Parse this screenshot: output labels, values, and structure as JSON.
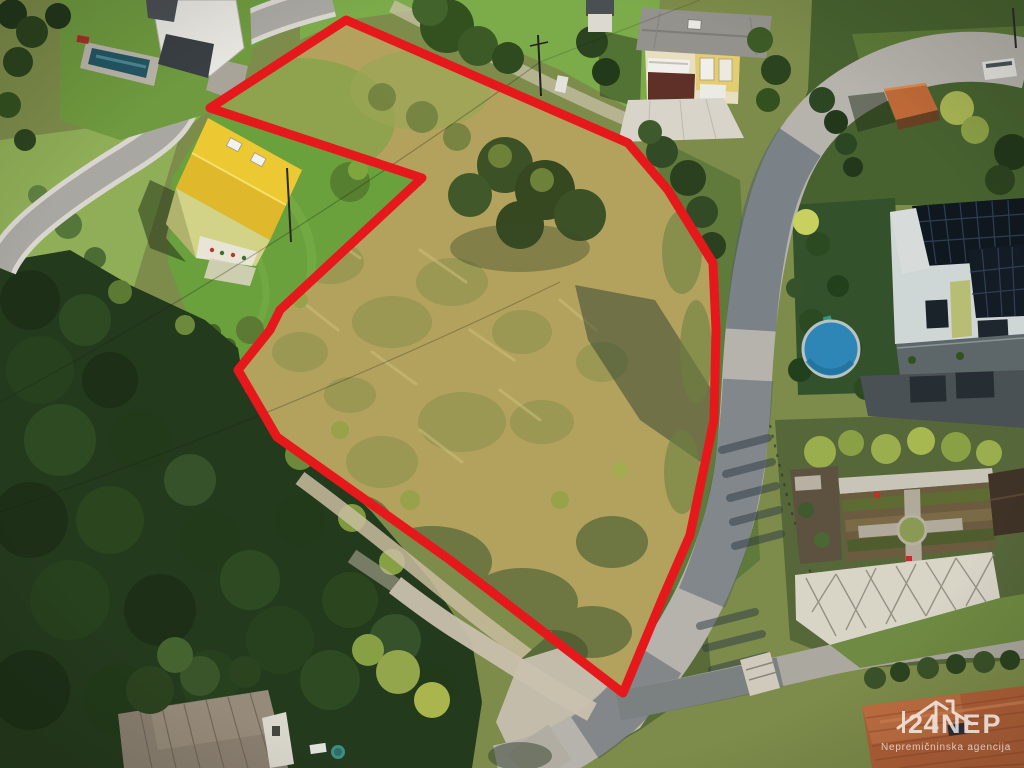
{
  "meta": {
    "description": "Aerial drone photograph of a hillside building plot outlined with a red boundary, surrounded by houses, a curving road and forest"
  },
  "boundary": {
    "color": "#e5191c",
    "stroke_width": "9",
    "points": "346,20 415,50 628,143 668,190 713,263 716,330 714,420 690,535 663,597 623,693 450,560 277,437 238,370 270,330 280,310 422,178 210,108"
  },
  "watermark": {
    "brand_number": "24",
    "brand_name": "NEP",
    "tagline": "Nepremičninska agencija",
    "color": "#ffffff"
  },
  "palette": {
    "meadow_tan": "#b2a25e",
    "meadow_scrub": "#5d6c3a",
    "lawn_green": "#6aa13c",
    "forest_dark": "#243a1d",
    "road_lit": "#b6b3ad",
    "road_shadow": "#53616e",
    "roof_yellow": "#ecc832",
    "roof_gray": "#94928c",
    "roof_orange": "#b06038",
    "solar_dark": "#10181f",
    "pool_round_blue": "#2d86b5",
    "pool_lap_teal": "#235663"
  }
}
